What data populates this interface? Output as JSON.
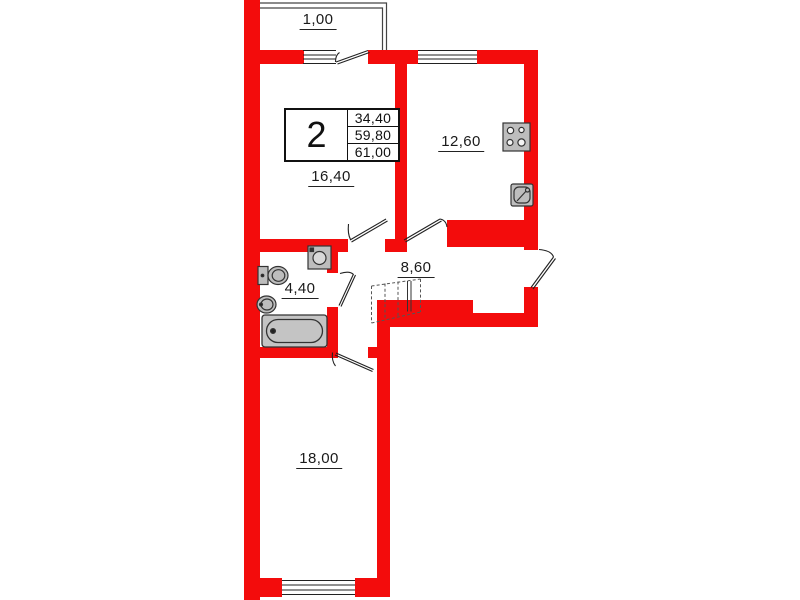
{
  "plan": {
    "type": "apartment-floor-plan",
    "summary": {
      "rooms_count": "2",
      "areas": [
        "34,40",
        "59,80",
        "61,00"
      ]
    },
    "labels": {
      "balcony": "1,00",
      "living_room": "16,40",
      "kitchen": "12,60",
      "hallway": "8,60",
      "bathroom": "4,40",
      "bedroom": "18,00"
    },
    "fixtures": [
      "stove",
      "kitchen-sink",
      "washing-machine",
      "toilet",
      "washbasin",
      "bathtub",
      "wardrobe"
    ],
    "colors": {
      "wall": "#f30c0c",
      "line": "#333333",
      "fixture_fill": "#c0c0c0",
      "background": "#ffffff"
    }
  }
}
